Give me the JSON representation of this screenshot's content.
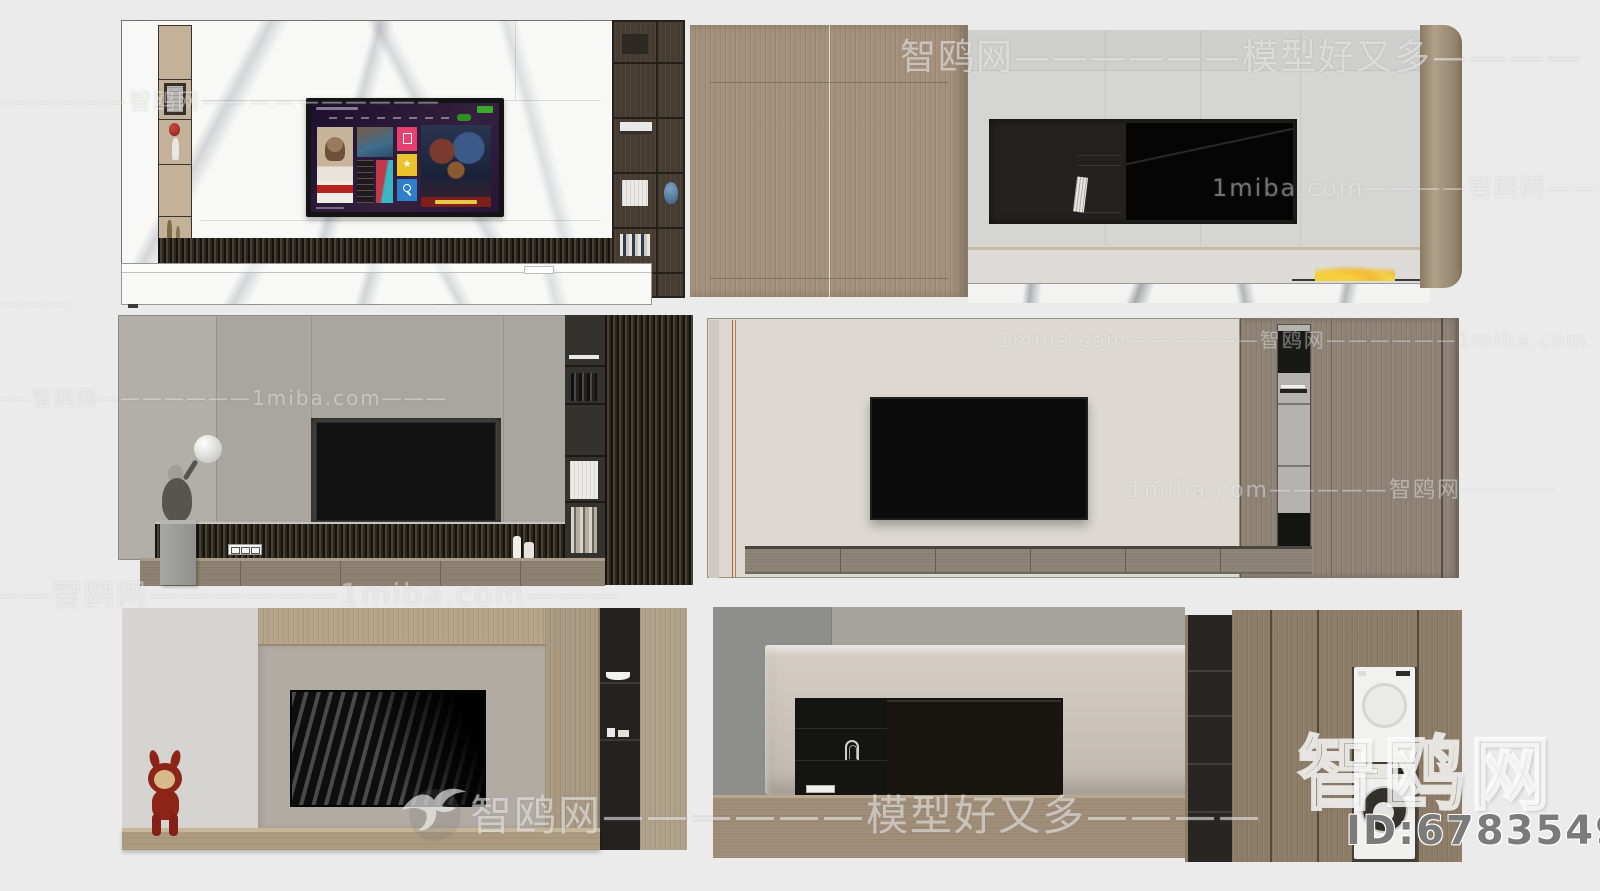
{
  "branding": {
    "site_name": "智鸥网",
    "domain": "1miba.com",
    "tagline": "模型好又多",
    "model_id": "ID:678354986"
  },
  "watermarks": {
    "bands": [
      {
        "text": "智鸥网——————模型好又多————"
      },
      {
        "text": "——————智鸥网——————————"
      },
      {
        "text": "1miba.com————智鸥网————"
      },
      {
        "text": "1miba.com——————智鸥网——————1miba.com"
      },
      {
        "text": "——智鸥网———————1miba.com———"
      },
      {
        "text": "1miba.com—————智鸥网————"
      },
      {
        "text": "——智鸥网——————1miba.com———"
      },
      {
        "text": "———"
      },
      {
        "text": "智鸥网——————模型好又多————"
      }
    ],
    "logo": "智鸥网",
    "id": "ID:678354986"
  },
  "palette": {
    "background": "#ebebeb",
    "marble_white": "#f8f8f7",
    "wood_warm": "#a3917c",
    "wood_cabinet": "#8d7c67",
    "wood_dark_shelf": "#463c31",
    "slat_dark": "#2b2620",
    "panel_gray": "#a9a59f",
    "cream_wall": "#ddd9d2",
    "taupe_panel": "#b1aba3",
    "niche_black": "#201f1e",
    "tv_black": "#0b0b0b",
    "tv_ui_purple": "#2a1838",
    "tile_pink": "#e8406e",
    "tile_yellow": "#eac32d",
    "tile_blue": "#2f80cc",
    "badge_green": "#3aa82c",
    "balloon_red": "#a82c22",
    "bunny_red": "#8c2418",
    "flame_yellow": "#f2c63c",
    "vase_blue": "#5b7fa6",
    "copper_line": "#a0683f"
  }
}
